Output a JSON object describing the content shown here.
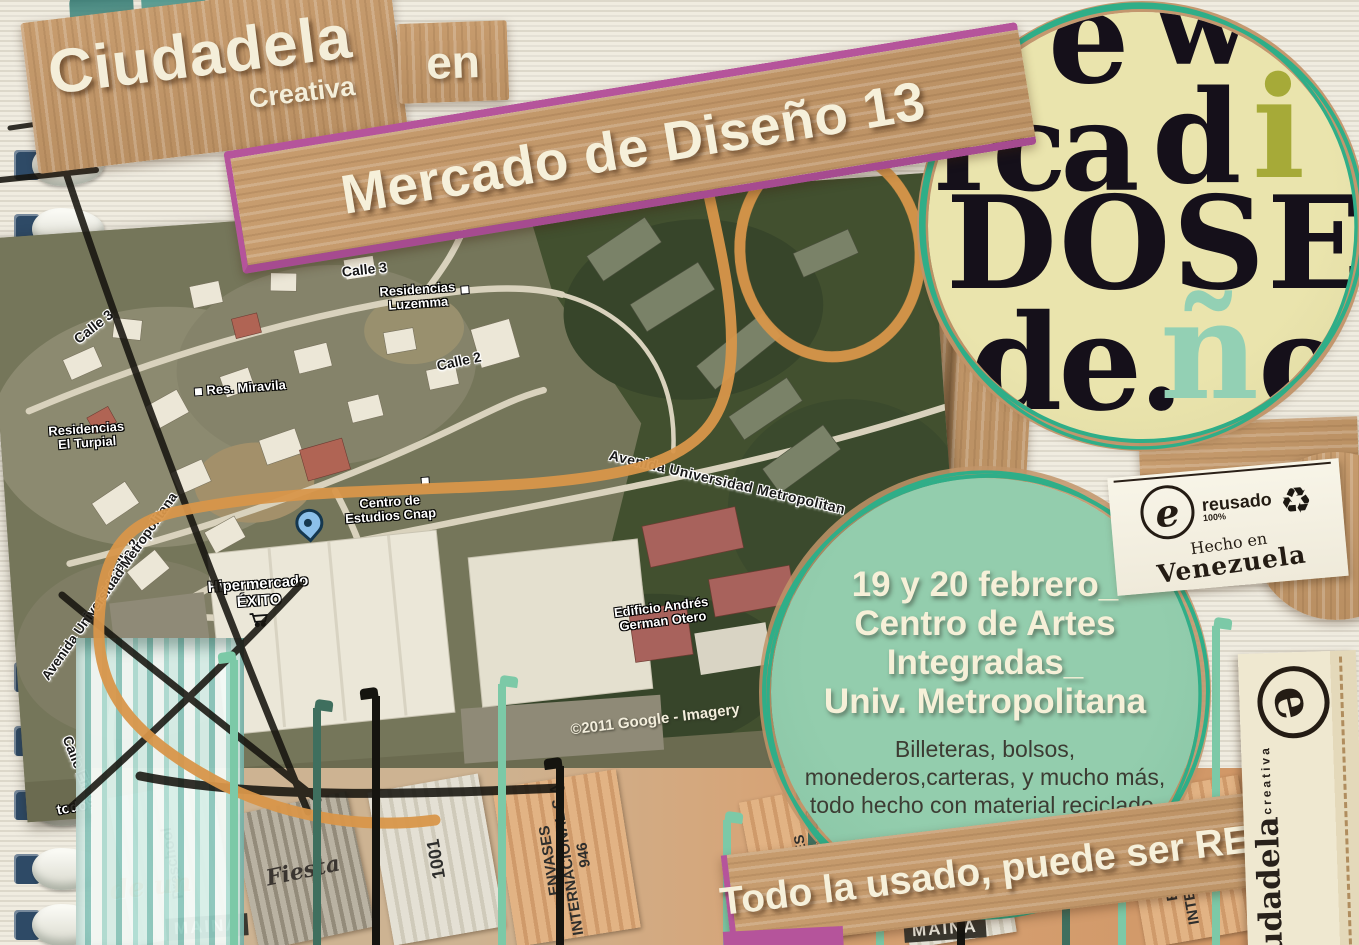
{
  "brand": {
    "title": "Ciudadela",
    "subtitle": "Creativa",
    "connector": "en"
  },
  "banner": {
    "text": "Mercado de Diseño 13"
  },
  "logo_circle": {
    "row1a": "e",
    "row1b": "w",
    "row2a": "rca",
    "row2b": "d",
    "row2c": "i",
    "row3": "DOSE",
    "row4a": "de.",
    "row4b": "ñ",
    "row4c": "o"
  },
  "map": {
    "labels": [
      {
        "text": "Calle 3"
      },
      {
        "text": "Calle 3"
      },
      {
        "line1": "Residencias",
        "line2": "Luzemma"
      },
      {
        "text": "Res. Miravila"
      },
      {
        "text": "Calle 2"
      },
      {
        "line1": "Residencias",
        "line2": "El Turpial"
      },
      {
        "text": "Calle 2"
      },
      {
        "text": "Avenida Universidad Metropolitana"
      },
      {
        "line1": "Centro de",
        "line2": "Estudios Cnap"
      },
      {
        "line1": "Hipermercado",
        "line2": "ÉXITO"
      },
      {
        "text": "Avenida Universidad Metropolitan"
      },
      {
        "line1": "Edificio Andrés",
        "line2": "German Otero"
      },
      {
        "text": "Calle Envolvente"
      },
      {
        "text": "todo"
      }
    ],
    "attribution": "©2011 Google - Imagery"
  },
  "stamp": {
    "logo": "e",
    "line1": "reusado",
    "line2": "100%",
    "recycle": "♻",
    "line3": "Hecho en",
    "line4": "Venezuela"
  },
  "event": {
    "line1": "19 y 20 febrero_",
    "line2": "Centro de Artes",
    "line3": "Integradas_",
    "line4": "Univ. Metropolitana",
    "description": "Billeteras, bolsos, monederos,carteras, y mucho más, todo hecho con material reciclado."
  },
  "footer": {
    "text": "Todo la usado, puede ser REUSADO."
  },
  "side_tag": {
    "logo": "e",
    "title": "Ciudadela",
    "subtitle": "creativa"
  },
  "collage": {
    "envases": "ENVASES",
    "internacional": "INTERNACIONAL S.A.",
    "num946": "946",
    "num1001": "1001",
    "preschool": "Preschool",
    "maina": "MAINA",
    "deun": "de un",
    "fiesta": "Fiesta"
  },
  "colors": {
    "magenta": "#b5549b",
    "orange": "#d9964a",
    "mint": "#8cc7a8",
    "teal": "#2fae88",
    "cardboard": "#c29868",
    "cream": "#f3edd8"
  }
}
